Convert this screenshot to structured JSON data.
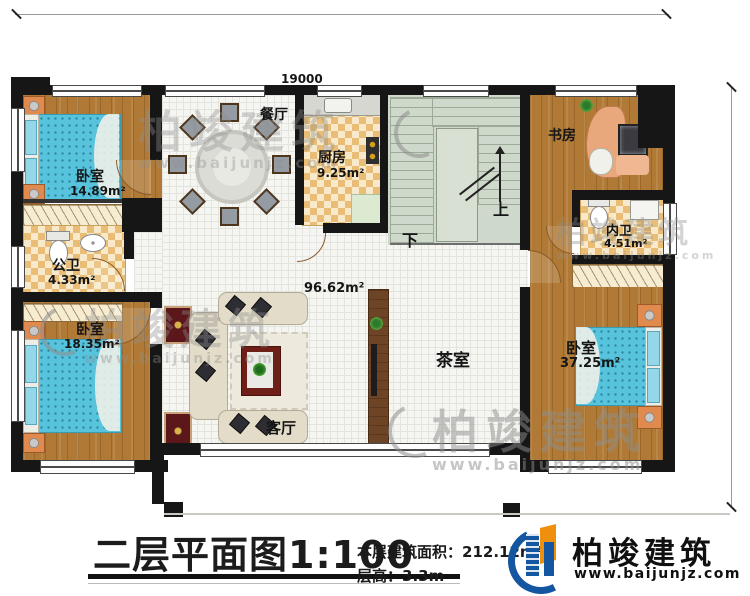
{
  "dimensions": {
    "top": "19000",
    "right": "12200"
  },
  "rooms": {
    "bedroom_tl": {
      "name": "卧室",
      "area": "14.89m²"
    },
    "bath_public": {
      "name": "公卫",
      "area": "4.33m²"
    },
    "bedroom_bl": {
      "name": "卧室",
      "area": "18.35m²"
    },
    "dining": {
      "name": "餐厅"
    },
    "kitchen": {
      "name": "厨房",
      "area": "9.25m²"
    },
    "hall": {
      "area": "96.62m²"
    },
    "living": {
      "name": "客厅"
    },
    "tea": {
      "name": "茶室"
    },
    "study": {
      "name": "书房"
    },
    "bath_ensuite": {
      "name": "内卫",
      "area": "4.51m²"
    },
    "bedroom_r": {
      "name": "卧室",
      "area": "37.25m²"
    },
    "stairs": {
      "up": "上",
      "down": "下"
    }
  },
  "title_block": {
    "title": "二层平面图1:100",
    "area_label": "本层建筑面积：",
    "area_value": "212.12m²",
    "height_label": "层高：",
    "height_value": "3.3m"
  },
  "brand": {
    "name": "柏竣建筑",
    "url": "www.baijunjz.com"
  },
  "watermark": {
    "name": "柏竣建筑",
    "url": "www.baijunjz.com"
  },
  "colors": {
    "wall": "#161616",
    "wood": "#b07a36",
    "checker": "#e9bd75",
    "stair": "#cfd9cb",
    "bed": "#57c3dc",
    "brand_blue": "#1456a0",
    "brand_orange": "#ef8f0e"
  }
}
